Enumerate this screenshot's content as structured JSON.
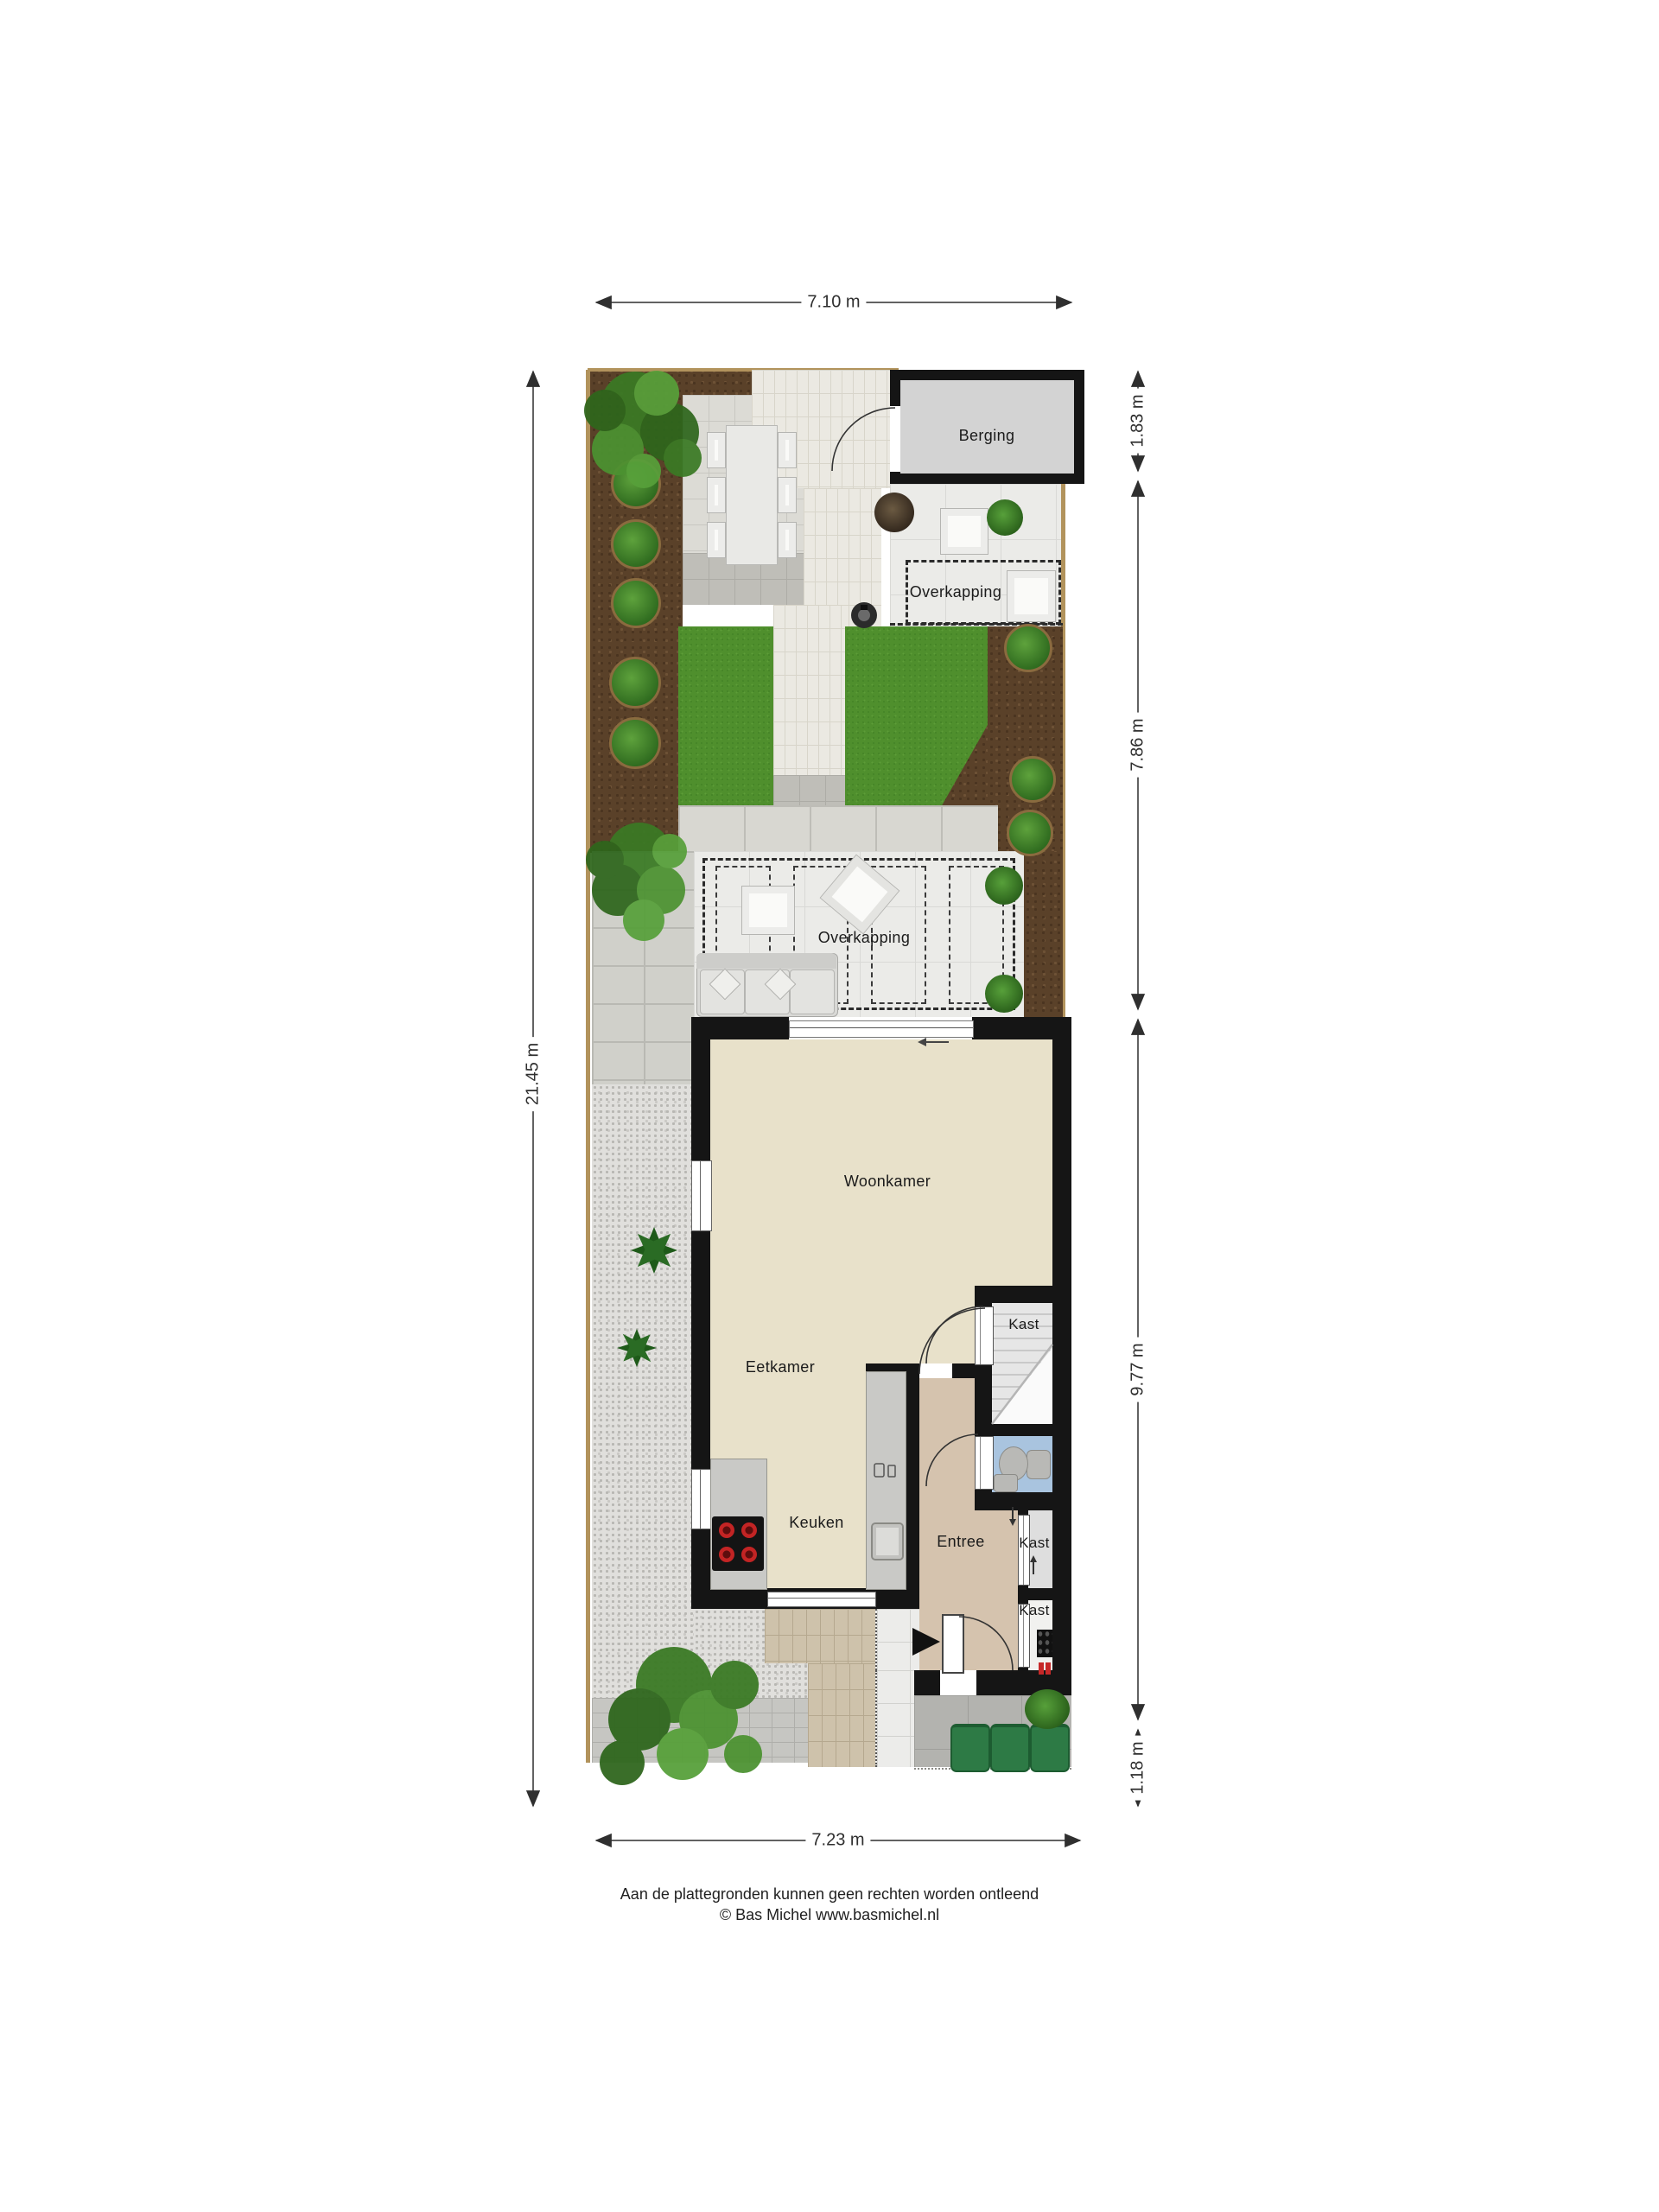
{
  "plan": {
    "rooms": {
      "berging": "Berging",
      "overkapping_top": "Overkapping",
      "overkapping_mid": "Overkapping",
      "woonkamer": "Woonkamer",
      "eetkamer": "Eetkamer",
      "keuken": "Keuken",
      "entree": "Entree",
      "kast_stairs": "Kast",
      "kast_mid": "Kast",
      "kast_meter": "Kast"
    },
    "dimensions": {
      "top": "7.10 m",
      "right_top": "1.83 m",
      "right_garden": "7.86 m",
      "right_house": "9.77 m",
      "right_front": "1.18 m",
      "left": "21.45 m",
      "bottom": "7.23 m"
    },
    "colors": {
      "wall": "#151515",
      "floor_living": "#e8e1ca",
      "floor_entree": "#d5c3ae",
      "floor_toilet": "#a9c4df",
      "floor_storage": "#d3d3d3",
      "grass": "#4f8f2d",
      "soil": "#5a4129",
      "bin_green": "#2d7a45",
      "burner_red": "#c32424"
    },
    "icons": {
      "tree": "tree-icon",
      "shrub": "shrub-icon",
      "sofa": "sofa-icon",
      "dining_table": "dining-table-icon",
      "stove": "stove-icon",
      "sink": "sink-icon",
      "toilet": "toilet-icon",
      "stairs": "stairs-icon",
      "wheelie_bin": "wheelie-bin-icon",
      "robot_mower": "robot-mower-icon",
      "door_arc": "door-swing-icon",
      "entrance_arrow": "entrance-arrow-icon"
    }
  },
  "footer": {
    "disclaimer": "Aan de plattegronden kunnen geen rechten worden ontleend",
    "copyright": "© Bas Michel www.basmichel.nl"
  }
}
